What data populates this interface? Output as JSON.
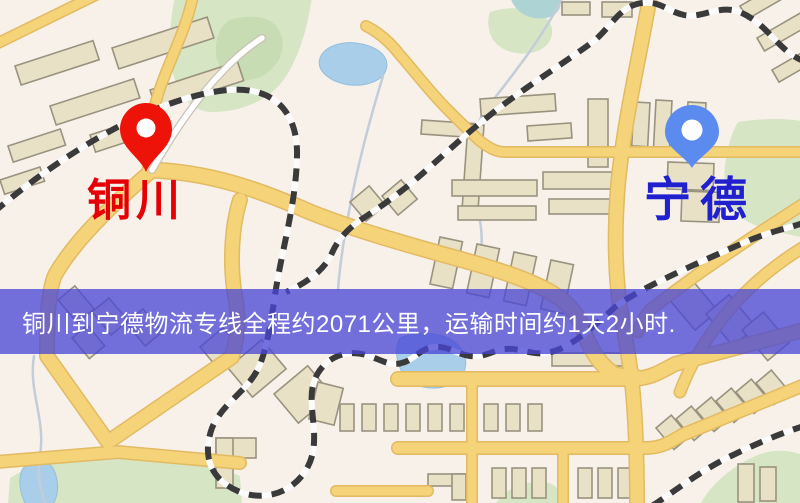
{
  "map": {
    "origin": {
      "label": "铜川",
      "label_color": "#e60005",
      "pin_color": "#ee1309",
      "pin_icon": "red-location-pin"
    },
    "destination": {
      "label": "宁德",
      "label_color": "#2020cf",
      "pin_color": "#5b8bee",
      "pin_icon": "blue-location-pin"
    },
    "banner": {
      "text": "铜川到宁德物流专线全程约2071公里，运输时间约1天2小时.",
      "background": "#4846d6",
      "text_color": "#ffffff"
    },
    "palette": {
      "map_background": "#f7f1ea",
      "road_major": "#f5d378",
      "road_casing": "#e2ba62",
      "road_minor": "#ffffff",
      "railway": "#3a3a3a",
      "park": "#d6e5c4",
      "water": "#a9cee9",
      "building_fill": "#e9e1c6",
      "building_stroke": "#99927f"
    }
  }
}
